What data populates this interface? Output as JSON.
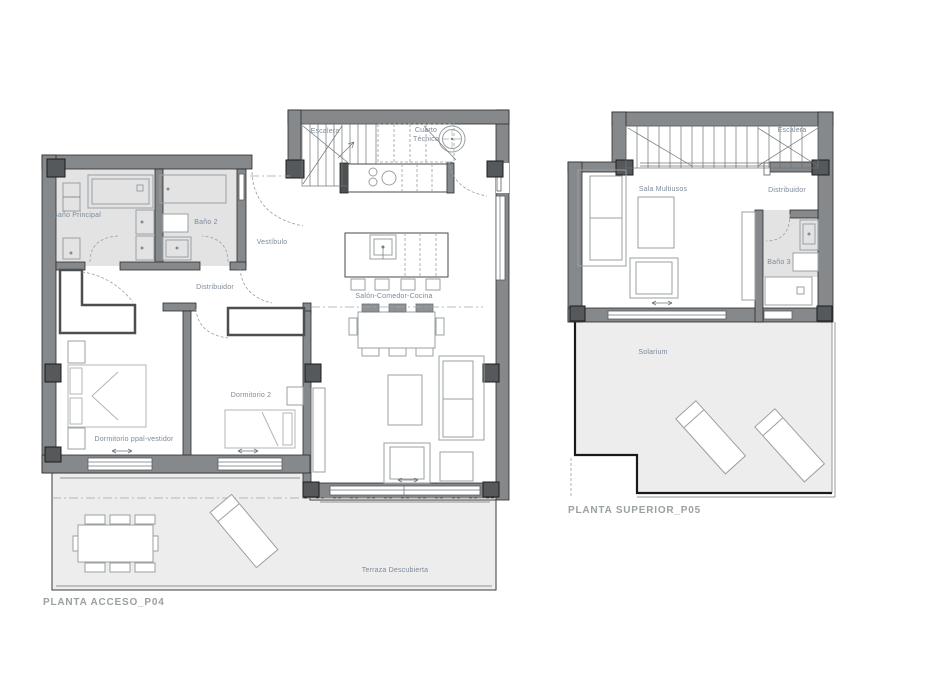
{
  "document": {
    "type": "architectural-floor-plan-sheet",
    "background_color": "#ffffff"
  },
  "colors": {
    "wall_fill": "#85898b",
    "pillar_fill": "#56595b",
    "bathroom_floor": "#e3e3e4",
    "terrace_floor": "#ededee",
    "furniture_stroke": "#9aa0a3",
    "room_label_text": "#7b8a98",
    "title_text": "#9aa0a3"
  },
  "plans": [
    {
      "id": "P04",
      "title": "PLANTA ACCESO_P04",
      "rooms": [
        {
          "id": "escalera",
          "label": "Escalera"
        },
        {
          "id": "cuarto_tecnico",
          "label": "Cuarto Técnico"
        },
        {
          "id": "bano_principal",
          "label": "Baño Principal"
        },
        {
          "id": "bano_2",
          "label": "Baño 2"
        },
        {
          "id": "vestibulo",
          "label": "Vestíbulo"
        },
        {
          "id": "distribuidor",
          "label": "Distribuidor"
        },
        {
          "id": "salon_comedor_cocina",
          "label": "Salón-Comedor-Cocina"
        },
        {
          "id": "dormitorio_ppal",
          "label": "Dormitorio ppal-vestidor"
        },
        {
          "id": "dormitorio_2",
          "label": "Dormitorio 2"
        },
        {
          "id": "terraza",
          "label": "Terraza Descubierta"
        }
      ]
    },
    {
      "id": "P05",
      "title": "PLANTA SUPERIOR_P05",
      "rooms": [
        {
          "id": "escalera",
          "label": "Escalera"
        },
        {
          "id": "sala_multiusos",
          "label": "Sala Multiusos"
        },
        {
          "id": "distribuidor",
          "label": "Distribuidor"
        },
        {
          "id": "bano_3",
          "label": "Baño 3"
        },
        {
          "id": "solarium",
          "label": "Solarium"
        }
      ]
    }
  ]
}
